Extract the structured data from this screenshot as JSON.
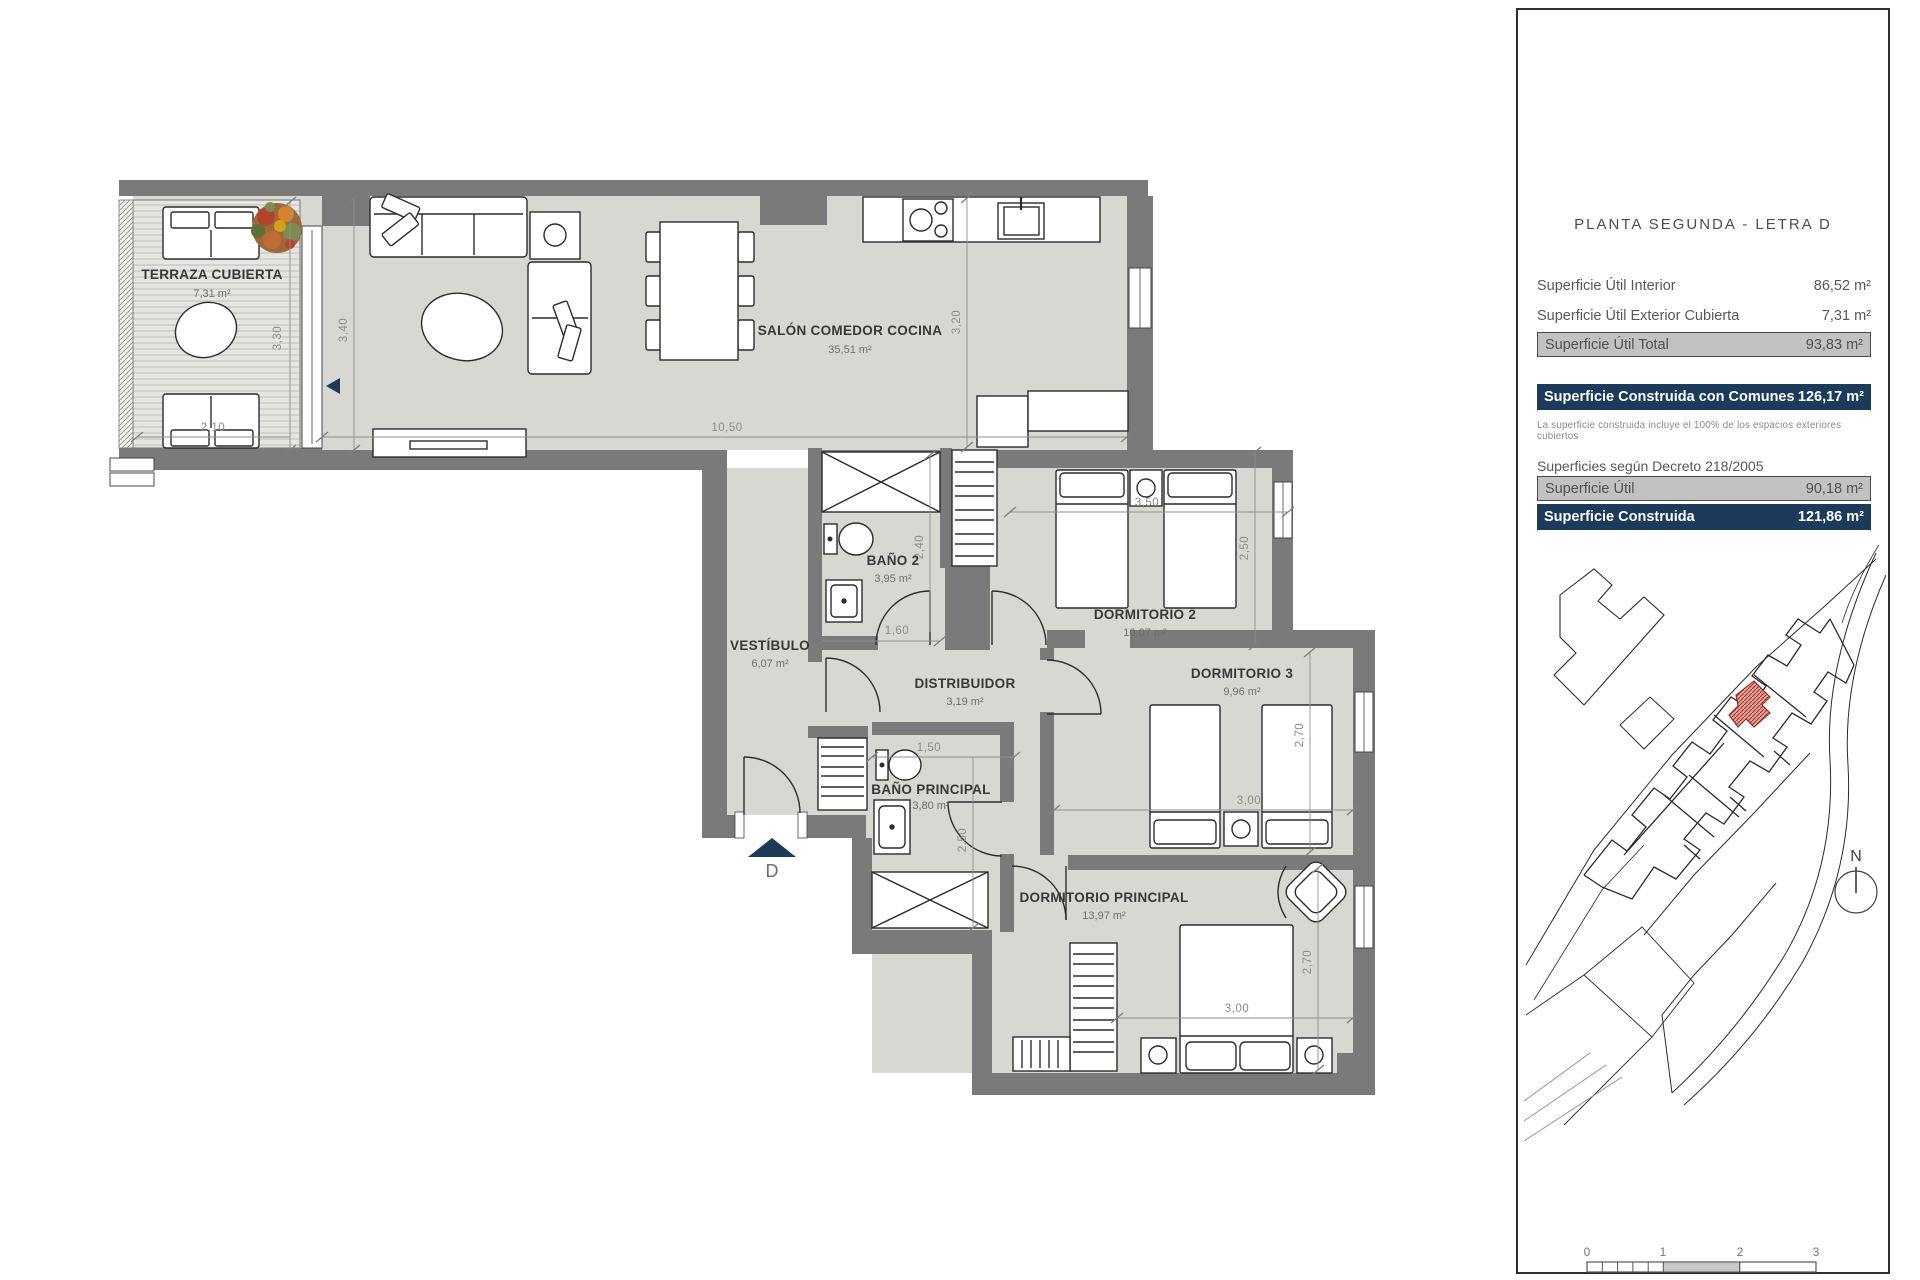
{
  "colors": {
    "navy_accent": "#1c3a5a",
    "wall_gray": "#7a7a7a",
    "floor_gray": "#d8d7d2",
    "terrace_gray": "#e6e5e1",
    "row_gray": "#c2c2c2",
    "site_highlight_red": "#a93226"
  },
  "panel": {
    "title": "PLANTA SEGUNDA - LETRA D",
    "surface_table": {
      "rows": [
        {
          "label": "Superficie Útil Interior",
          "value": "86,52 m²"
        },
        {
          "label": "Superficie Útil Exterior Cubierta",
          "value": "7,31 m²"
        }
      ],
      "total": {
        "label": "Superficie Útil Total",
        "value": "93,83 m²"
      }
    },
    "built_row": {
      "label": "Superficie Construida con Comunes",
      "value": "126,17 m²"
    },
    "note": "La superficie construida incluye el 100% de los espacios exteriores cubiertos",
    "decree_heading": "Superficies según Decreto 218/2005",
    "decree_rows": [
      {
        "label": "Superficie Útil",
        "value": "90,18 m²"
      },
      {
        "label": "Superficie Construida",
        "value": "121,86 m²"
      }
    ],
    "north_label": "N",
    "scale_labels": [
      "0",
      "1",
      "2",
      "3"
    ]
  },
  "plan": {
    "entrance_label": "D",
    "rooms": [
      {
        "name": "TERRAZA CUBIERTA",
        "area": "7,31 m²"
      },
      {
        "name": "SALÓN COMEDOR COCINA",
        "area": "35,51 m²"
      },
      {
        "name": "VESTÍBULO",
        "area": "6,07 m²"
      },
      {
        "name": "BAÑO 2",
        "area": "3,95 m²"
      },
      {
        "name": "DISTRIBUIDOR",
        "area": "3,19 m²"
      },
      {
        "name": "DORMITORIO 2",
        "area": "10,07 m²"
      },
      {
        "name": "DORMITORIO 3",
        "area": "9,96 m²"
      },
      {
        "name": "BAÑO PRINCIPAL",
        "area": "3,80 m²"
      },
      {
        "name": "DORMITORIO PRINCIPAL",
        "area": "13,97 m²"
      }
    ],
    "dims": [
      {
        "v": "3,30"
      },
      {
        "v": "3,40"
      },
      {
        "v": "3,20"
      },
      {
        "v": "2,10"
      },
      {
        "v": "10,50"
      },
      {
        "v": "3,50"
      },
      {
        "v": "2,50"
      },
      {
        "v": "2,40"
      },
      {
        "v": "1,60"
      },
      {
        "v": "1,50"
      },
      {
        "v": "2,50"
      },
      {
        "v": "3,00"
      },
      {
        "v": "2,70"
      },
      {
        "v": "3,00"
      },
      {
        "v": "2,70"
      }
    ]
  }
}
